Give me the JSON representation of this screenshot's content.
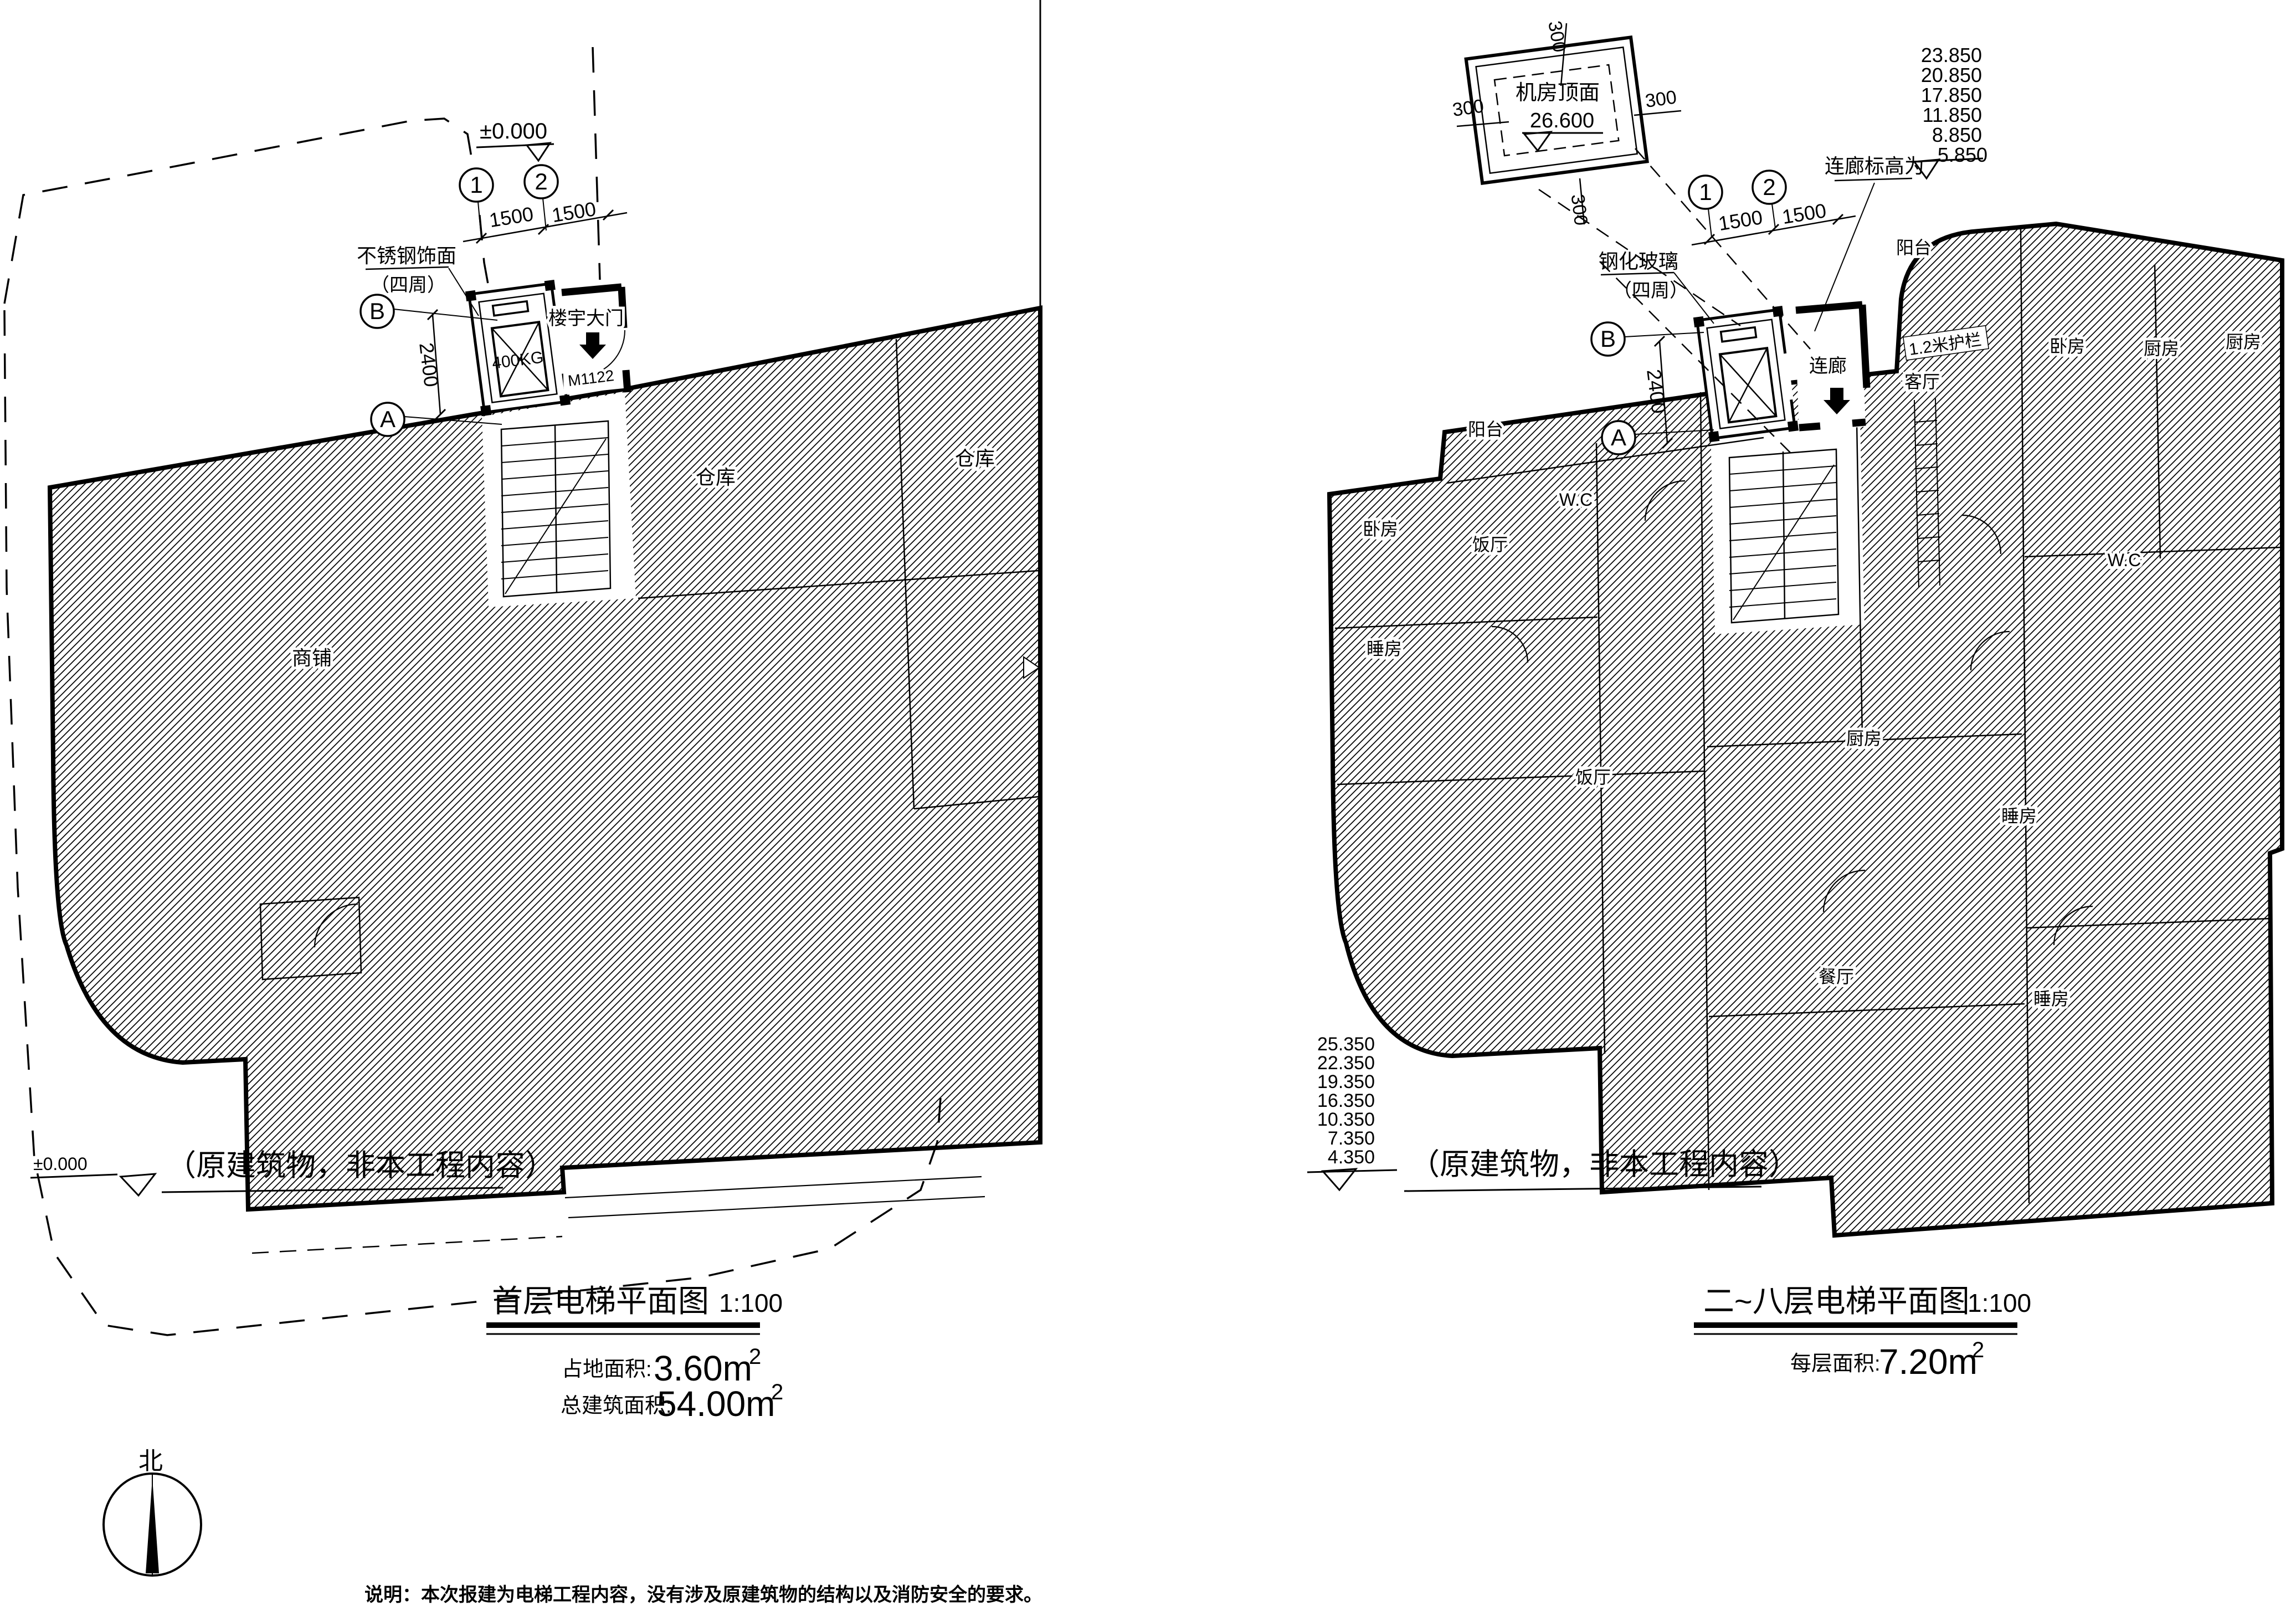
{
  "document": {
    "note": "说明：本次报建为电梯工程内容，没有涉及原建筑物的结构以及消防安全的要求。",
    "north_label": "北"
  },
  "grid": {
    "col1": "1",
    "col2": "2",
    "row_a": "A",
    "row_b": "B",
    "bay": "1500",
    "depth": "2400",
    "wall": "300"
  },
  "left_plan": {
    "title": "首层电梯平面图",
    "scale": "1:100",
    "stats": [
      {
        "label": "占地面积:",
        "value": "3.60m",
        "sup": "2"
      },
      {
        "label": "总建筑面积:",
        "value": "54.00m",
        "sup": "2"
      }
    ],
    "level_top": "±0.000",
    "level_ground": "±0.000",
    "existing_note": "（原建筑物，非本工程内容）",
    "finish_line1": "不锈钢饰面",
    "finish_line2": "（四周）",
    "entrance": "楼宇大门",
    "door_code": "M1122",
    "elevator_capacity": "400KG",
    "rooms": [
      "商铺",
      "仓库",
      "仓库"
    ]
  },
  "right_plan": {
    "title": "二~八层电梯平面图",
    "scale": "1:100",
    "stats": [
      {
        "label": "每层面积:",
        "value": "7.20m",
        "sup": "2"
      }
    ],
    "machine_room": {
      "label": "机房顶面",
      "level": "26.600"
    },
    "corridor_levels": [
      "23.850",
      "20.850",
      "17.850",
      "11.850",
      "8.850",
      "5.850"
    ],
    "corridor_note": "连廊标高为",
    "floor_levels": [
      "25.350",
      "22.350",
      "19.350",
      "16.350",
      "10.350",
      "7.350",
      "4.350"
    ],
    "existing_note": "（原建筑物，非本工程内容）",
    "glass_line1": "钢化玻璃",
    "glass_line2": "（四周）",
    "corridor": "连廊",
    "railing": "1.2米护栏",
    "rooms": [
      "阳台",
      "卧房",
      "厨房",
      "厨房",
      "阳台",
      "W.C",
      "客厅",
      "卧房",
      "饭厅",
      "W.C",
      "睡房",
      "厨房",
      "饭厅",
      "睡房",
      "餐厅",
      "睡房"
    ]
  }
}
